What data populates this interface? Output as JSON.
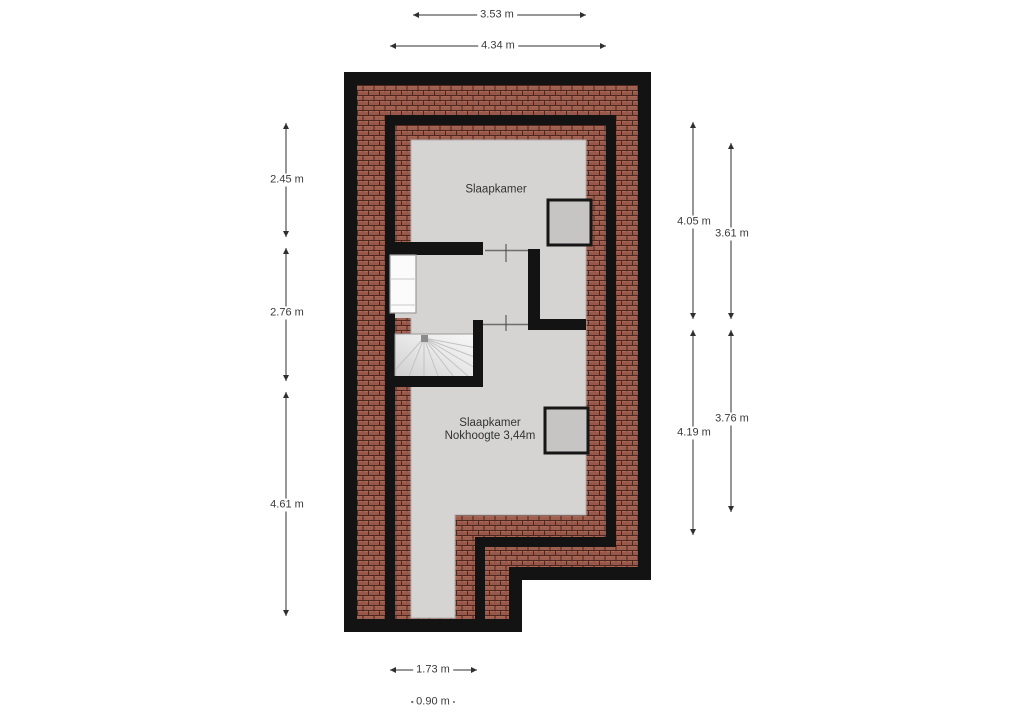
{
  "floorplan": {
    "rooms": {
      "top_bedroom": "Slaapkamer",
      "bottom_bedroom": "Slaapkamer",
      "bottom_bedroom_note": "Nokhoogte 3,44m"
    },
    "dimensions": {
      "top_inner_width": "3.53 m",
      "top_outer_width": "4.34 m",
      "left_upper": "2.45 m",
      "left_middle": "2.76 m",
      "left_lower": "4.61 m",
      "right_upper_outer": "4.05 m",
      "right_upper_inner": "3.61 m",
      "right_lower_outer": "4.19 m",
      "right_lower_inner": "3.76 m",
      "bottom_stair_width": "1.73 m",
      "bottom_strip_width": "0.90 m"
    },
    "colors": {
      "wall": "#131313",
      "floor": "#d5d4d2",
      "roof_brick": "#98584a",
      "brick_mortar": "#50271f",
      "window_fill": "#c6c5c3",
      "stair_fill_light": "#f6f6f6",
      "stair_fill_dark": "#cfcfcf",
      "dimension_text": "#3a3a3a"
    }
  }
}
